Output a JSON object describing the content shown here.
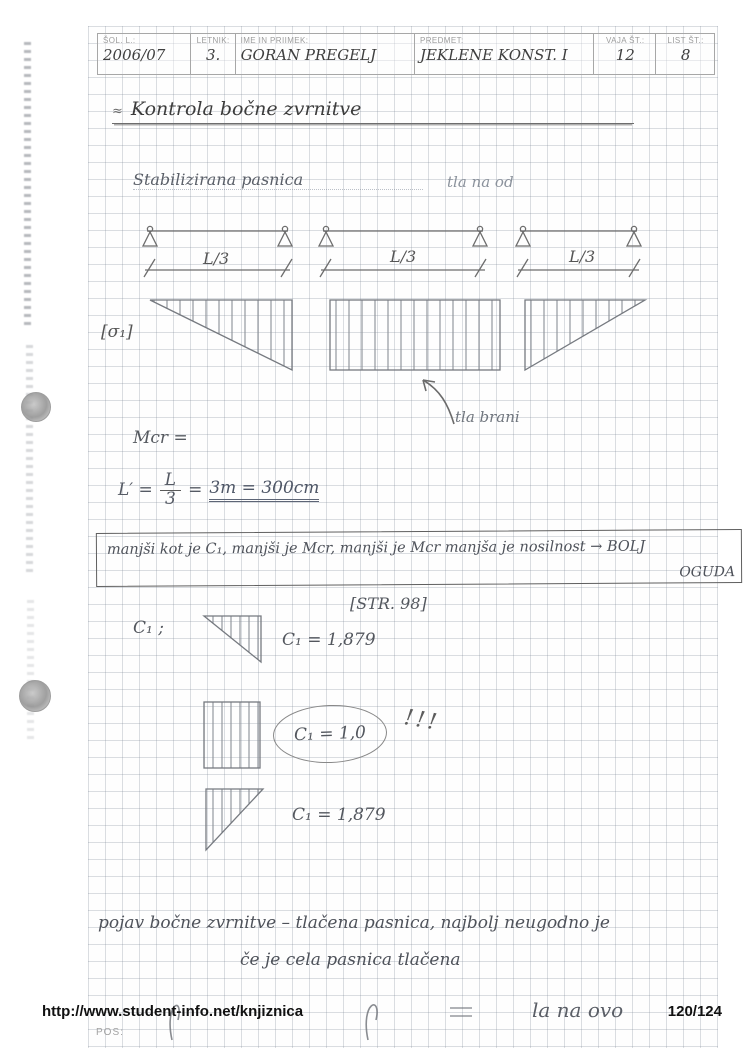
{
  "header": {
    "fields": [
      {
        "label": "ŠOL. L.:",
        "value": "2006/07"
      },
      {
        "label": "LETNIK:",
        "value": "3."
      },
      {
        "label": "IME IN PRIIMEK:",
        "value": "GORAN PREGELJ"
      },
      {
        "label": "PREDMET:",
        "value": "JEKLENE KONST. I"
      },
      {
        "label": "VAJA ŠT.:",
        "value": "12"
      },
      {
        "label": "LIST ŠT.:",
        "value": "8"
      }
    ]
  },
  "title": {
    "marker": "≈",
    "text": "Kontrola bočne zvrnitve"
  },
  "diagram": {
    "subtitle_left": "Stabilizirana pasnica",
    "subtitle_right": "tla na od",
    "span_labels": [
      "L/3",
      "L/3",
      "L/3"
    ],
    "moment_label": "[σ₁]",
    "arrow_note": "tla brani"
  },
  "calc": {
    "mcr_line": "Mcr =",
    "length": {
      "lhs": "L′ =",
      "num": "L",
      "den": "3",
      "eq": "=",
      "result": "3m = 300cm"
    },
    "boxed_note_line1": "manjši kot je C₁, manjši je Mcr, manjši je Mcr manjša je nosilnost → BOLJ",
    "boxed_note_line2": "OGUDA",
    "reference": "[STR. 98]",
    "c1_intro": "C₁ ;",
    "c1_case1": "C₁ = 1,879",
    "c1_case2": "C₁ = 1,0",
    "c1_case2_emphasis": "!!!",
    "c1_case3": "C₁ = 1,879"
  },
  "paragraph": {
    "line1": "pojav bočne zvrnitve – tlačena pasnica, najbolj neugodno je",
    "line2": "če je cela pasnica tlačena"
  },
  "bottom_fragment": "la na ovo",
  "footer": {
    "url": "http://www.student-info.net/knjiznica",
    "page": "120/124",
    "pos_label": "POS:"
  }
}
